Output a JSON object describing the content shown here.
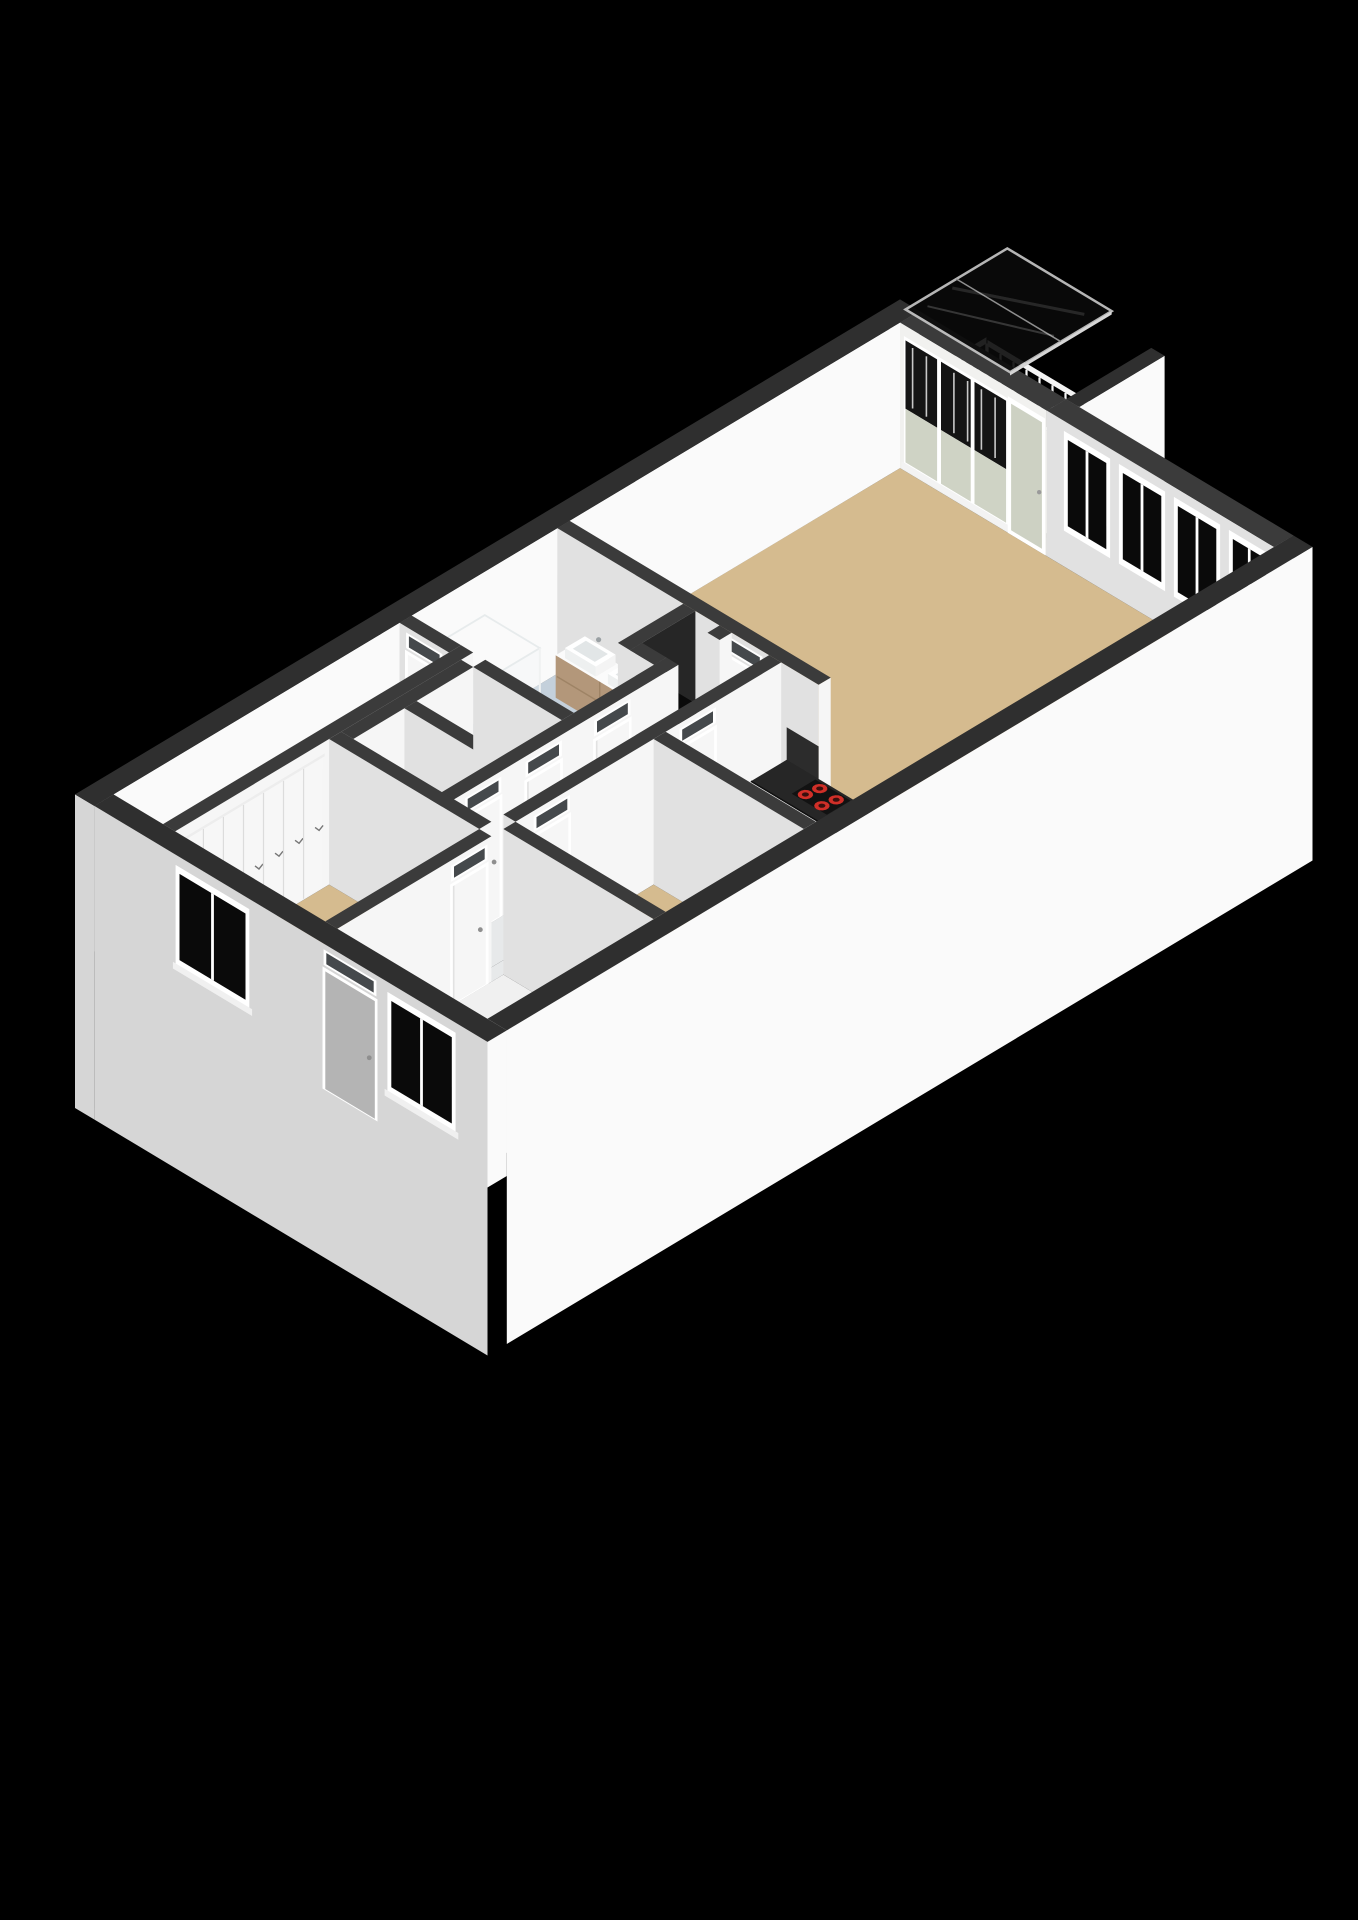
{
  "meta": {
    "description": "isometric-3d-floor-plan-render",
    "background": "#000000",
    "canvas": {
      "width": 1358,
      "height": 1920
    }
  },
  "view": {
    "ox": 75,
    "oy": 940,
    "kx": 55,
    "ky": 33,
    "kh": 56,
    "wallHeight": 2.6,
    "slabDepth": 3.0
  },
  "palette": {
    "bg": "#000000",
    "wallTop": "#3b3b3b",
    "wallTopExt": "#2f2f2f",
    "faceSE": "#f6f6f6",
    "faceSW": "#e1e1e1",
    "faceExtSE": "#fafafa",
    "faceExtSW": "#d6d6d6",
    "floorTan": "#d5bb8f",
    "floorWhite": "#f0f0f0",
    "floorGray": "#e7e9ea",
    "floorGrayLight": "#dfe2e4",
    "floorBlue": "#c4d0db",
    "floorBalcony": "#c8c9bb",
    "floorDark": "#141414",
    "glassDark": "#0a0a0a",
    "glassSage": "#cfd3c5",
    "glassDoor": "#cdd1c3",
    "frame": "#ffffff",
    "doorPanel": "#f6f6f6",
    "doorGray": "#b4b4b4",
    "transom": "#45494c",
    "counterTop": "#262626",
    "cabinet": "#f2f2f2",
    "wood": "#b3977a",
    "woodDark": "#a58a6d",
    "steel": "#b7bcbf",
    "steelDark": "#8f9599",
    "burner": "#d02f28",
    "railing": "#f4f4f4",
    "canopy": "#0b0b0b",
    "canopyFrame": "#c9c9c9",
    "backsplash": "#2c2c2c",
    "boilerBody": "#121212",
    "boilerLed": "#e03128",
    "showerGlass": "rgba(232,239,243,0.38)",
    "showerEdge": "#e7ebec",
    "trayBlue": "#d7dee4"
  },
  "floors": [
    {
      "name": "storage-room-floor",
      "rect": [
        0.35,
        0.35,
        5.55,
        1.25
      ],
      "color": "floorWhite"
    },
    {
      "name": "wardrobe-bedroom-floor",
      "rect": [
        0.35,
        1.47,
        3.15,
        4.2
      ],
      "color": "floorTan"
    },
    {
      "name": "toilet-floor",
      "rect": [
        3.37,
        1.69,
        4.3,
        3.3
      ],
      "color": "floorGrayLight"
    },
    {
      "name": "shower-room-floor",
      "rect": [
        4.52,
        1.69,
        5.55,
        3.3
      ],
      "color": "floorGrayLight"
    },
    {
      "name": "bathroom-floor",
      "rect": [
        5.77,
        0.35,
        8.42,
        2.64
      ],
      "color": "floorBlue"
    },
    {
      "name": "bathroom-floor-ext",
      "rect": [
        5.77,
        2.64,
        7.23,
        3.3
      ],
      "color": "floorBlue"
    },
    {
      "name": "tech-niche-floor",
      "rect": [
        7.45,
        2.86,
        8.2,
        3.3
      ],
      "color": "floorDark"
    },
    {
      "name": "niche-side-floor",
      "rect": [
        8.2,
        2.86,
        8.42,
        3.3
      ],
      "color": "floorGrayLight"
    },
    {
      "name": "corridor-floor",
      "rect": [
        3.15,
        3.52,
        8.42,
        4.2
      ],
      "color": "floorGray"
    },
    {
      "name": "hall-passage-floor",
      "rect": [
        3.15,
        4.2,
        3.59,
        4.42
      ],
      "color": "floorGray"
    },
    {
      "name": "entrance-hall-floor",
      "rect": [
        0.35,
        4.42,
        3.37,
        7.15
      ],
      "color": "floorWhite"
    },
    {
      "name": "bedroom-floor",
      "rect": [
        3.59,
        4.42,
        6.1,
        7.15
      ],
      "color": "floorTan"
    },
    {
      "name": "kitchen-floor",
      "rect": [
        6.32,
        4.42,
        8.42,
        7.15
      ],
      "color": "floorWhite"
    },
    {
      "name": "living-room-floor",
      "rect": [
        8.64,
        0.35,
        14.65,
        7.15
      ],
      "color": "floorTan"
    },
    {
      "name": "balcony-floor",
      "rect": [
        15.0,
        0.0,
        16.55,
        3.02
      ],
      "color": "floorBalcony"
    }
  ],
  "elements": [
    {
      "type": "railing",
      "name": "balcony-railing-nw",
      "dir": "x",
      "x1": 15.04,
      "x2": 16.5,
      "y": 0.07,
      "count": 12
    },
    {
      "type": "railing",
      "name": "balcony-railing-ne",
      "dir": "y",
      "x": 16.47,
      "y1": 0.12,
      "y2": 2.96,
      "count": 13
    },
    {
      "type": "wall",
      "name": "facade-nw",
      "rect": [
        0,
        0,
        15,
        0.35
      ],
      "ext": true,
      "swLow": true
    },
    {
      "type": "glazedWall",
      "name": "balcony-window-wall",
      "rect": [
        14.65,
        0.35,
        15,
        3.02
      ]
    },
    {
      "type": "wall",
      "name": "balcony-side-wall",
      "rect": [
        15.0,
        3.02,
        16.55,
        3.26
      ],
      "ext": true,
      "h0": -0.2
    },
    {
      "type": "wall",
      "name": "facade-ne",
      "rect": [
        14.65,
        3.02,
        15,
        7.15
      ],
      "windowsSW": [
        [
          3.4,
          4.1
        ],
        [
          4.4,
          5.1
        ],
        [
          5.4,
          6.1
        ],
        [
          6.4,
          7.0
        ]
      ]
    },
    {
      "type": "wall",
      "name": "wall-living-core",
      "rect": [
        8.42,
        0.35,
        8.64,
        5.1
      ],
      "doorSW": [
        3.45,
        4.05
      ],
      "backsplashSW": [
        4.52,
        5.1,
        1.5
      ]
    },
    {
      "type": "vanity",
      "name": "bathroom-vanity",
      "rect": [
        7.99,
        0.75,
        8.42,
        2.35
      ],
      "h": 0.82,
      "basins": [
        [
          8.03,
          0.88,
          8.39,
          1.44
        ],
        [
          8.03,
          1.66,
          8.39,
          2.22
        ]
      ],
      "faucets": [
        [
          8.36,
          1.16
        ],
        [
          8.36,
          1.94
        ]
      ]
    },
    {
      "type": "shower",
      "name": "shower-enclosure",
      "rect": [
        5.92,
        0.5,
        6.95,
        1.5
      ],
      "h": 2.0
    },
    {
      "type": "wall",
      "name": "wall-niche-back",
      "rect": [
        7.23,
        2.64,
        8.42,
        2.86
      ],
      "seColor": "#262626"
    },
    {
      "type": "wall",
      "name": "wall-storage-bath",
      "rect": [
        5.55,
        0.35,
        5.77,
        1.25
      ],
      "doorSW": [
        0.5,
        1.1
      ]
    },
    {
      "type": "boiler",
      "name": "boiler-unit",
      "rect": [
        7.58,
        2.88,
        8.08,
        3.22
      ],
      "h0": 0.55,
      "h1": 1.35,
      "leds": [
        [
          7.74,
          1.02
        ],
        [
          7.9,
          0.86
        ]
      ]
    },
    {
      "type": "wall",
      "name": "wall-niche-stub",
      "rect": [
        8.2,
        3.3,
        8.42,
        3.52
      ]
    },
    {
      "type": "wall",
      "name": "wall-niche-side",
      "rect": [
        7.23,
        2.86,
        7.45,
        3.3
      ]
    },
    {
      "type": "wall",
      "name": "tech-niche-lip",
      "rect": [
        7.45,
        3.3,
        8.2,
        3.52
      ],
      "h1": 0.12,
      "topColor": "#ececec"
    },
    {
      "type": "wall",
      "name": "wall-closet-back",
      "rect": [
        0.35,
        1.25,
        5.77,
        1.47
      ]
    },
    {
      "type": "closets",
      "name": "wardrobe-closet-row",
      "y": 1.47,
      "x1": 0.5,
      "x2": 3.05,
      "count": 7,
      "h": 2.34
    },
    {
      "type": "wall",
      "name": "wall-cells-nw",
      "rect": [
        3.37,
        1.47,
        5.55,
        1.69
      ]
    },
    {
      "type": "wall",
      "name": "wall-toilet-shower",
      "rect": [
        4.3,
        1.69,
        4.52,
        3.3
      ]
    },
    {
      "type": "wall",
      "name": "wall-cells-bath",
      "rect": [
        5.55,
        1.69,
        5.77,
        3.3
      ]
    },
    {
      "type": "wall",
      "name": "wall-corridor-nw",
      "rect": [
        3.15,
        3.3,
        7.45,
        3.52
      ],
      "doorsSE": [
        [
          3.6,
          4.2
        ],
        [
          4.7,
          5.3
        ],
        [
          5.95,
          6.55
        ]
      ]
    },
    {
      "type": "wall",
      "name": "wall-corridor-se",
      "rect": [
        3.59,
        4.2,
        8.42,
        4.42
      ],
      "doorsSE": [
        [
          3.95,
          4.55
        ],
        [
          6.6,
          7.2
        ]
      ]
    },
    {
      "type": "counter",
      "name": "kitchen-counter",
      "rect": [
        7.77,
        4.52,
        8.42,
        7.15
      ],
      "h": 0.92,
      "cooktop": [
        7.95,
        5.08,
        8.38,
        5.72
      ],
      "burners": [
        [
          8.06,
          5.22
        ],
        [
          8.28,
          5.26
        ],
        [
          8.04,
          5.54
        ],
        [
          8.26,
          5.58
        ]
      ],
      "burnerR": 0.1,
      "sink": [
        7.98,
        6.34,
        8.38,
        6.96
      ],
      "seams": [
        5.1,
        5.7,
        6.3,
        6.8
      ]
    },
    {
      "type": "wall",
      "name": "wall-bedroom-kitchen",
      "rect": [
        6.1,
        4.42,
        6.32,
        7.15
      ]
    },
    {
      "type": "wall",
      "name": "wall-wardrobe-cells",
      "rect": [
        3.15,
        1.47,
        3.37,
        4.2
      ]
    },
    {
      "type": "wall",
      "name": "wall-hall-bedroom",
      "rect": [
        3.37,
        4.42,
        3.59,
        7.15
      ]
    },
    {
      "type": "wall",
      "name": "wall-wardrobe-hall",
      "rect": [
        0.35,
        4.2,
        3.15,
        4.42
      ],
      "doorsSE": [
        [
          2.45,
          3.05
        ]
      ]
    },
    {
      "type": "wall",
      "name": "facade-sw",
      "rect": [
        0,
        0.35,
        0.35,
        7.5
      ],
      "ext": true,
      "swLow": true,
      "windowsSW": [
        [
          1.9,
          3.1
        ],
        [
          5.75,
          6.85
        ]
      ],
      "entranceSW": [
        4.55,
        5.45
      ]
    },
    {
      "type": "wall",
      "name": "facade-se",
      "rect": [
        0.35,
        7.15,
        15,
        7.5
      ],
      "ext": true,
      "skipSW": true,
      "seLow": true
    },
    {
      "type": "canopy",
      "name": "balcony-glass-canopy",
      "rect": [
        15.05,
        0.05,
        16.9,
        1.95
      ],
      "h": 2.42
    }
  ]
}
